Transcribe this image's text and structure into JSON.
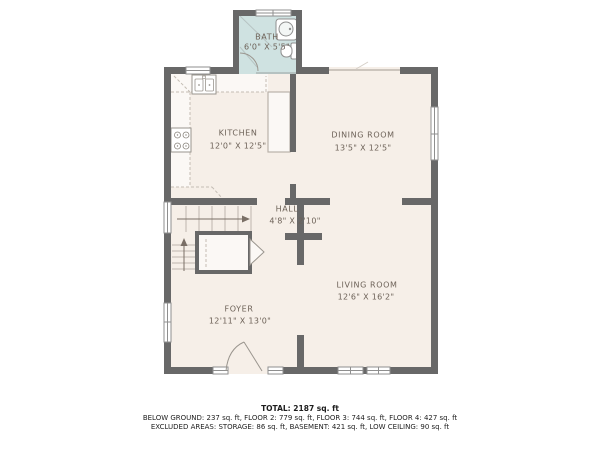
{
  "plan": {
    "rooms": [
      {
        "id": "bath",
        "name": "BATH",
        "dims": "6'0\" X 5'5\""
      },
      {
        "id": "kitchen",
        "name": "KITCHEN",
        "dims": "12'0\" X 12'5\""
      },
      {
        "id": "dining",
        "name": "DINING ROOM",
        "dims": "13'5\" X 12'5\""
      },
      {
        "id": "hall",
        "name": "HALL",
        "dims": "4'8\" X 2'10\""
      },
      {
        "id": "living",
        "name": "LIVING ROOM",
        "dims": "12'6\" X 16'2\""
      },
      {
        "id": "foyer",
        "name": "FOYER",
        "dims": "12'11\" X 13'0\""
      }
    ],
    "fixtures": [
      "bath-sink",
      "toilet",
      "kitchen-sink",
      "stove",
      "pantry-cabinet",
      "closet",
      "stairs-up",
      "front-door",
      "bath-door"
    ],
    "colors": {
      "wall": "#686868",
      "floor": "#f6efe8",
      "bath_floor": "#cfe2e1",
      "fixture_fill": "#fbf8f5",
      "dashed_line": "#c4bdb4",
      "label_text": "#6d6258"
    },
    "summary": {
      "total": "TOTAL: 2187 sq. ft",
      "line2": "BELOW GROUND: 237 sq. ft, FLOOR 2: 779 sq. ft, FLOOR 3: 744 sq. ft, FLOOR 4: 427 sq. ft",
      "line3": "EXCLUDED AREAS: STORAGE: 86 sq. ft, BASEMENT: 421 sq. ft, LOW CEILING: 90 sq. ft"
    }
  }
}
